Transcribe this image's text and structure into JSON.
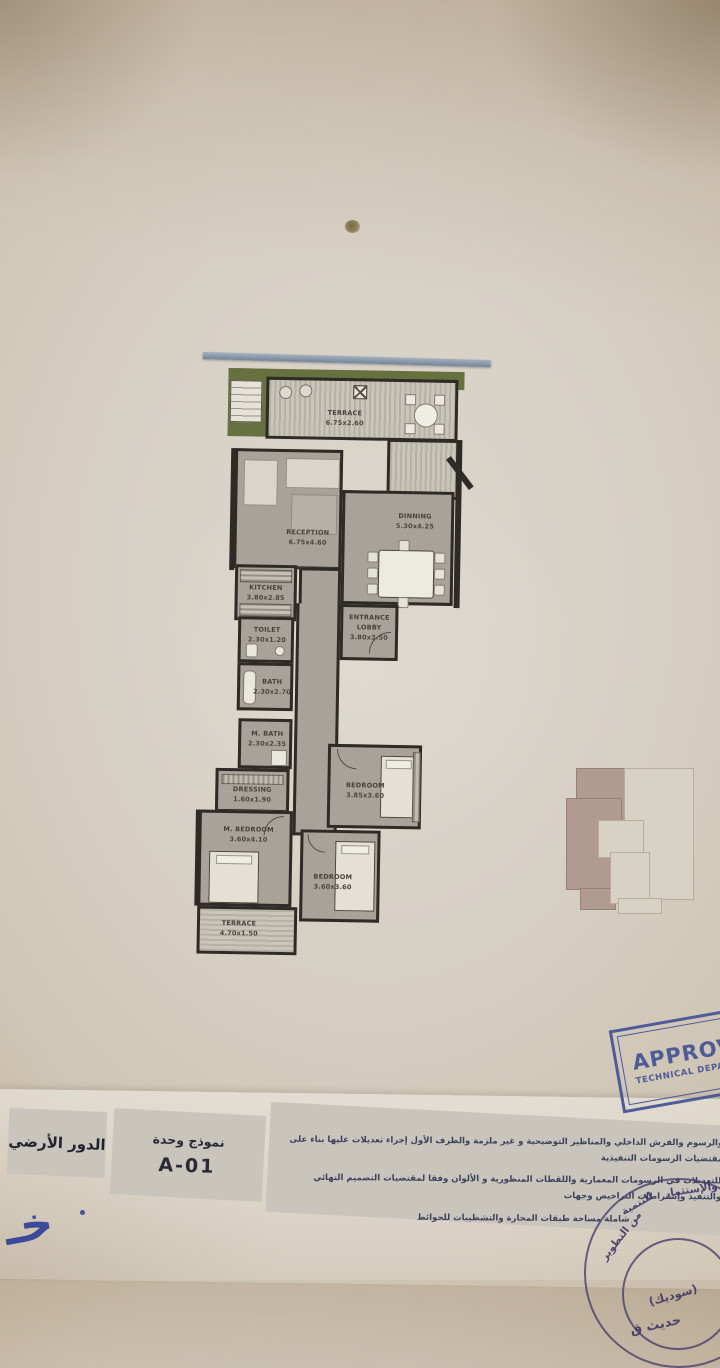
{
  "plan": {
    "rooms": [
      {
        "name": "TERRACE",
        "dims": "6.75x2.60"
      },
      {
        "name": "DINNING",
        "dims": "5.30x4.25"
      },
      {
        "name": "RECEPTION",
        "dims": "6.75x4.60"
      },
      {
        "name": "KITCHEN",
        "dims": "3.80x2.85"
      },
      {
        "name": "ENTRANCE LOBBY",
        "dims": "3.80x2.50"
      },
      {
        "name": "TOILET",
        "dims": "2.30x1.20"
      },
      {
        "name": "BATH",
        "dims": "2.30x2.70"
      },
      {
        "name": "M. BATH",
        "dims": "2.30x2.35"
      },
      {
        "name": "DRESSING",
        "dims": "1.60x1.90"
      },
      {
        "name": "BEDROOM",
        "dims": "3.85x3.60"
      },
      {
        "name": "M. BEDROOM",
        "dims": "3.60x4.10"
      },
      {
        "name": "BEDROOM",
        "dims": "3.60x3.60"
      },
      {
        "name": "TERRACE",
        "dims": "4.70x1.50"
      }
    ]
  },
  "title_block": {
    "floor_name_ar": "الدور الأرضي",
    "unit_model_label_ar": "نموذج وحدة",
    "unit_code": "A-01",
    "notes_ar": [
      "والرسوم والفرش الداخلي والمناظير التوضيحية و غير ملزمة والطرف الأول إجراء تعديلات عليها بناء على مقتضيات الرسومات التنفيذية",
      "للتعديلات في الرسومات المعمارية واللقطات المنظورية و الألوان وفقا لمقتضيات التصميم النهائي والتنفيذ وإشتراطات التراخيص وجهات",
      "شاملة مساحة طبقات المحارة والتشطيبات للحوائط"
    ]
  },
  "stamps": {
    "approved_title": "APPROVED",
    "approved_subtitle": "TECHNICAL DEPARTMENT",
    "round_ring_ar": [
      "من التطوير",
      "للتنمية",
      "والإستثمار"
    ],
    "round_center_ar": "(سوديك)",
    "round_center2_ar": "حديث ق"
  },
  "handwriting_ar": "خـ",
  "colors": {
    "paper": "#d6cec2",
    "wall": "#2e2a25",
    "room_fill": "#a8a29a",
    "terrace_green": "#67703f",
    "railing_blue": "#8494a6",
    "stamp_blue": "#4e5b99",
    "keyplan_mauve": "#b19b91",
    "note_ink": "#3d405a"
  }
}
